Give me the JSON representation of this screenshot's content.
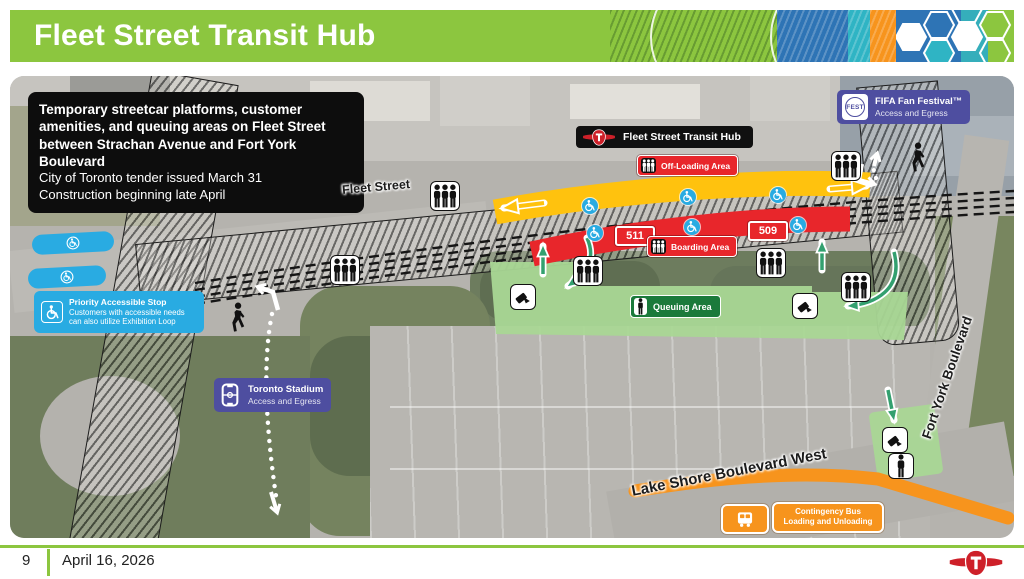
{
  "header": {
    "title": "Fleet Street Transit Hub"
  },
  "footer": {
    "page_number": "9",
    "date": "April 16, 2026"
  },
  "callout": {
    "bold": "Temporary streetcar platforms, customer amenities, and queuing areas on Fleet Street between Strachan Avenue and Fort York Boulevard",
    "line1": "City of Toronto tender issued March 31",
    "line2": "Construction beginning late April"
  },
  "map": {
    "hub_label": "Fleet Street Transit Hub",
    "off_loading_label": "Off-Loading Area",
    "boarding_label": "Boarding Area",
    "queuing_label": "Queuing Area",
    "route_badges": [
      "511",
      "509"
    ],
    "streets": {
      "fleet": "Fleet Street",
      "lake_shore": "Lake Shore Boulevard West",
      "fort_york": "Fort York Boulevard"
    },
    "accessible_stop": {
      "title": "Priority Accessible Stop",
      "body": "Customers with accessible needs can also utilize Exhibition Loop"
    },
    "stadium": {
      "title": "Toronto Stadium",
      "subtitle": "Access and Egress"
    },
    "fifa": {
      "logo_text": "FEST",
      "title": "FIFA Fan Festival™",
      "subtitle": "Access and Egress"
    },
    "contingency": {
      "line1": "Contingency Bus",
      "line2": "Loading and Unloading"
    }
  },
  "icons": [
    "ttc-logo",
    "passenger-group-icon",
    "fare-tap-icon",
    "pedestrian-icon",
    "wheelchair-icon",
    "stadium-icon",
    "bus-icon",
    "queue-person-icon",
    "fest-logo"
  ],
  "colors": {
    "header": "#8CC63F",
    "yellow": "#FFC20E",
    "red": "#E8262B",
    "qgreen": "#A9D795",
    "qlabel": "#1B7A3B",
    "blue": "#29ABE2",
    "purple": "#4E4EA0",
    "orange": "#F7941D",
    "agreen": "#33A06F"
  }
}
